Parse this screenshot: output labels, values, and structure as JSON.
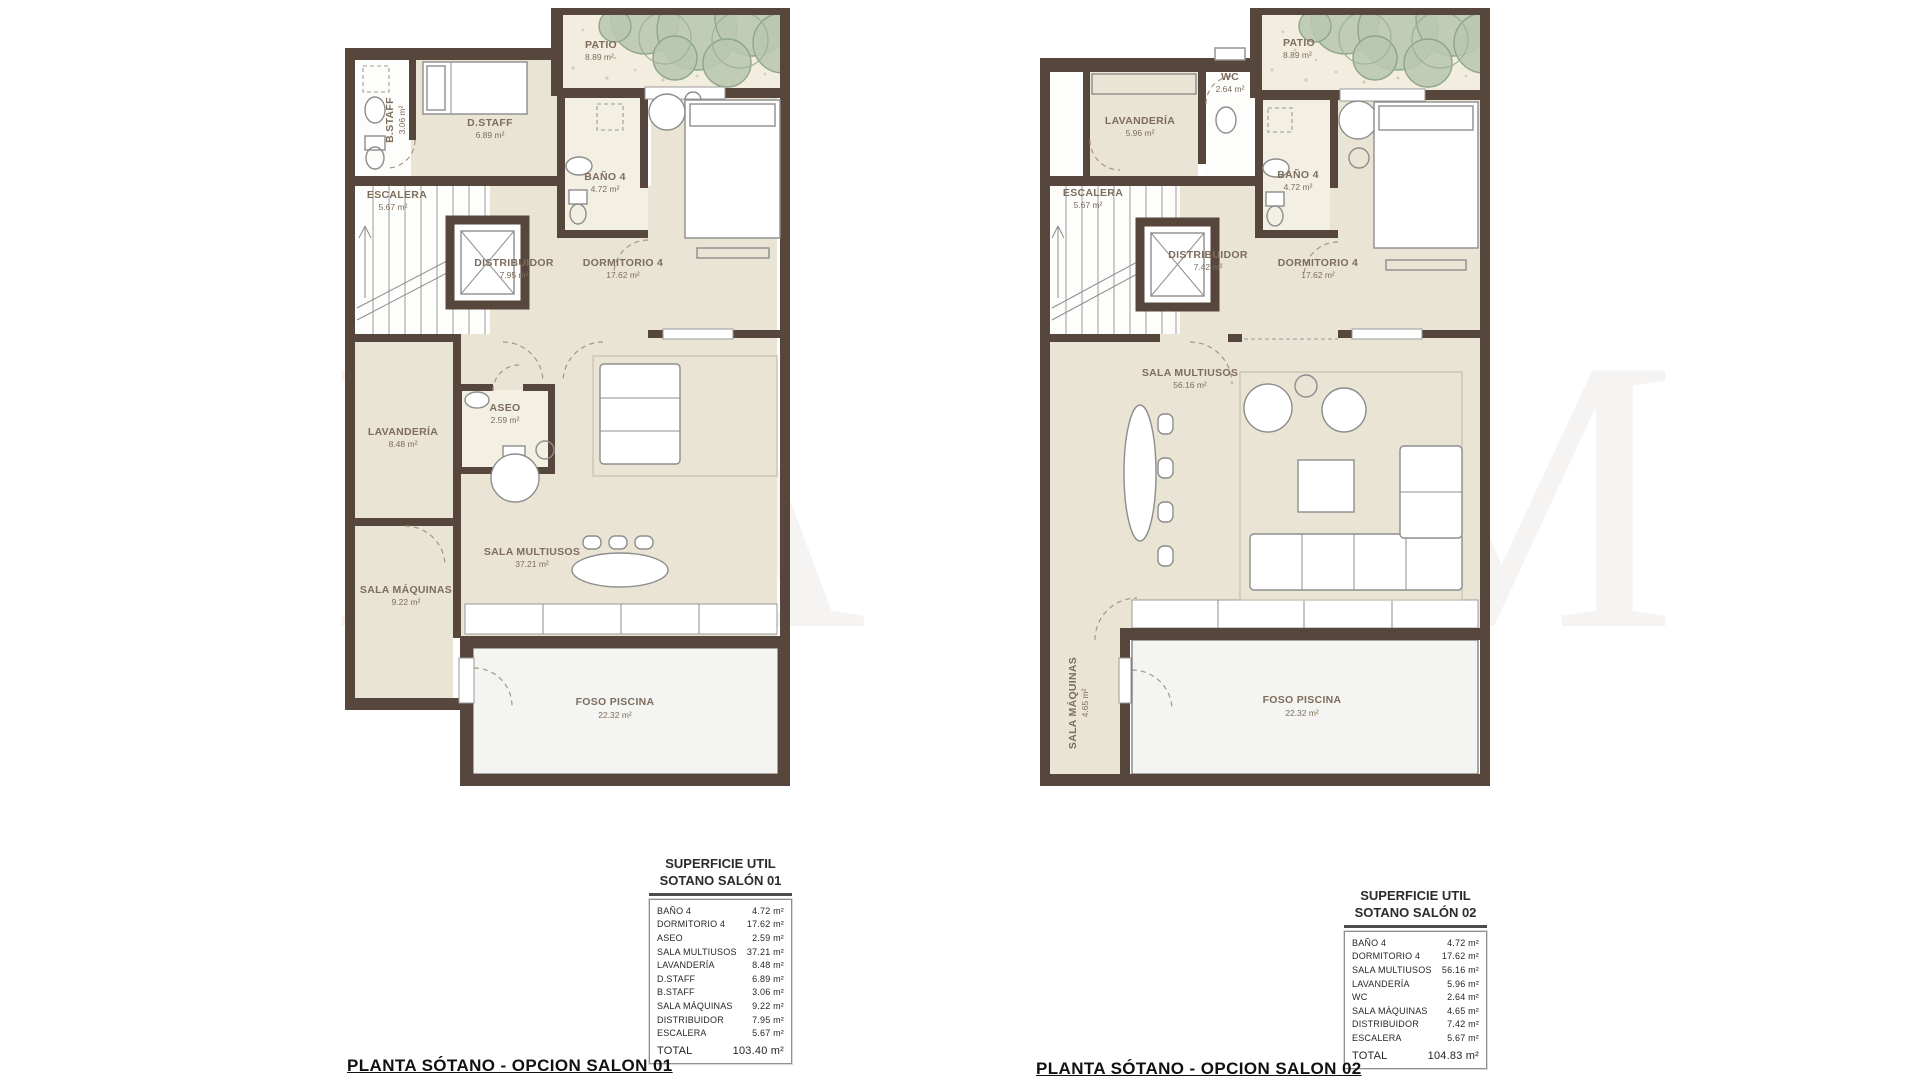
{
  "palette": {
    "wall": "#57463c",
    "floor": "#eae4d4",
    "bath_floor": "#f3efe3",
    "pool": "#f4f4f2",
    "plant": "#bac8af",
    "label_text": "#7d6d5c",
    "title_text": "#111111"
  },
  "watermark": {
    "letters": [
      "M",
      "A",
      "A",
      "M"
    ]
  },
  "plans": [
    {
      "title": "PLANTA SÓTANO - OPCION SALON 01",
      "rooms": {
        "patio": {
          "name": "PATIO",
          "area": "8.89 m²"
        },
        "bstaff": {
          "name": "B.STAFF",
          "area": "3.06 m²"
        },
        "dstaff": {
          "name": "D.STAFF",
          "area": "6.89 m²"
        },
        "bano4": {
          "name": "BAÑO 4",
          "area": "4.72 m²"
        },
        "escalera": {
          "name": "ESCALERA",
          "area": "5.67 m²"
        },
        "distribuidor": {
          "name": "DISTRIBUIDOR",
          "area": "7.95 m²"
        },
        "dormitorio4": {
          "name": "DORMITORIO 4",
          "area": "17.62 m²"
        },
        "aseo": {
          "name": "ASEO",
          "area": "2.59 m²"
        },
        "lavanderia": {
          "name": "LAVANDERÍA",
          "area": "8.48 m²"
        },
        "sala_multiusos": {
          "name": "SALA MULTIUSOS",
          "area": "37.21 m²"
        },
        "sala_maquinas": {
          "name": "SALA MÁQUINAS",
          "area": "9.22 m²"
        },
        "foso_piscina": {
          "name": "FOSO PISCINA",
          "area": "22.32 m²"
        }
      },
      "legend": {
        "title_line1": "SUPERFICIE UTIL",
        "title_line2": "SOTANO SALÓN 01",
        "rows": [
          {
            "label": "BAÑO 4",
            "value": "4.72 m²"
          },
          {
            "label": "DORMITORIO 4",
            "value": "17.62 m²"
          },
          {
            "label": "ASEO",
            "value": "2.59 m²"
          },
          {
            "label": "SALA MULTIUSOS",
            "value": "37.21 m²"
          },
          {
            "label": "LAVANDERÍA",
            "value": "8.48 m²"
          },
          {
            "label": "D.STAFF",
            "value": "6.89 m²"
          },
          {
            "label": "B.STAFF",
            "value": "3.06 m²"
          },
          {
            "label": "SALA MÁQUINAS",
            "value": "9.22 m²"
          },
          {
            "label": "DISTRIBUIDOR",
            "value": "7.95 m²"
          },
          {
            "label": "ESCALERA",
            "value": "5.67 m²"
          }
        ],
        "total": {
          "label": "TOTAL",
          "value": "103.40 m²"
        }
      }
    },
    {
      "title": "PLANTA SÓTANO - OPCION SALON 02",
      "rooms": {
        "patio": {
          "name": "PATIO",
          "area": "8.89 m²"
        },
        "lavanderia": {
          "name": "LAVANDERÍA",
          "area": "5.96 m²"
        },
        "wc": {
          "name": "WC",
          "area": "2.64 m²"
        },
        "bano4": {
          "name": "BAÑO 4",
          "area": "4.72 m²"
        },
        "escalera": {
          "name": "ESCALERA",
          "area": "5.67 m²"
        },
        "distribuidor": {
          "name": "DISTRIBUIDOR",
          "area": "7.42 m²"
        },
        "dormitorio4": {
          "name": "DORMITORIO 4",
          "area": "17.62 m²"
        },
        "sala_multiusos": {
          "name": "SALA MULTIUSOS",
          "area": "56.16 m²"
        },
        "sala_maquinas": {
          "name": "SALA MÁQUINAS",
          "area": "4.65 m²"
        },
        "foso_piscina": {
          "name": "FOSO PISCINA",
          "area": "22.32 m²"
        }
      },
      "legend": {
        "title_line1": "SUPERFICIE UTIL",
        "title_line2": "SOTANO SALÓN 02",
        "rows": [
          {
            "label": "BAÑO 4",
            "value": "4.72 m²"
          },
          {
            "label": "DORMITORIO 4",
            "value": "17.62 m²"
          },
          {
            "label": "SALA MULTIUSOS",
            "value": "56.16 m²"
          },
          {
            "label": "LAVANDERÍA",
            "value": "5.96 m²"
          },
          {
            "label": "WC",
            "value": "2.64 m²"
          },
          {
            "label": "SALA MÁQUINAS",
            "value": "4.65 m²"
          },
          {
            "label": "DISTRIBUIDOR",
            "value": "7.42 m²"
          },
          {
            "label": "ESCALERA",
            "value": "5.67 m²"
          }
        ],
        "total": {
          "label": "TOTAL",
          "value": "104.83 m²"
        }
      }
    }
  ]
}
